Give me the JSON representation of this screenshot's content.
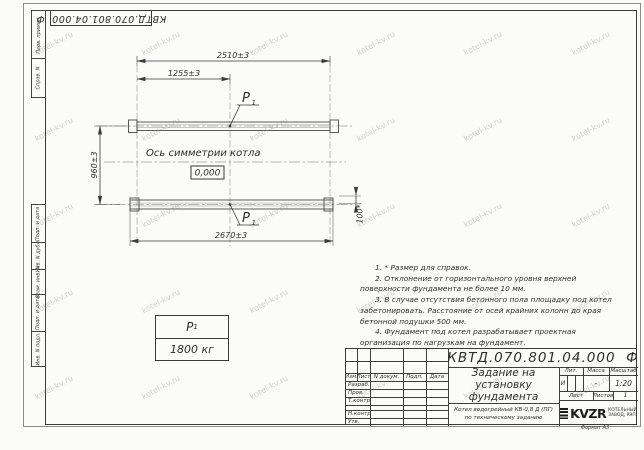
{
  "sheet": {
    "designation_top": "КВТД.070.801.04.000  Ф",
    "format_label": "Формат А3",
    "watermark": "kotel-kv.ru"
  },
  "margin_labels": [
    "Перв. примен.",
    "Справ. N",
    "Подп. и дата",
    "Инв. N дубл.",
    "Взам. инв. N",
    "Подп. и дата",
    "Инв. N подл."
  ],
  "drawing": {
    "dim_top": "2510±3",
    "dim_mid": "1255±3",
    "dim_left": "960±3",
    "dim_bottom": "2670±3",
    "dim_right": "100*",
    "axis_label": "Ось симметрии котла",
    "elevation": "0,000",
    "load_label": "P",
    "load_sub": "1"
  },
  "load_table": {
    "label": "P",
    "sub": "1",
    "value": "1800 кг"
  },
  "notes": [
    "1. * Размер для справок.",
    "2. Отклонение от горизонтального уровня верхней поверхности фундамента не более 10 мм.",
    "3. В случае отсутствия бетонного пола площадку под котел забетонировать. Расстояние от осей крайних колонн до края бетонной подушки 500 мм.",
    "4. Фундамент под котел разрабатывает проектная организация по нагрузкам на фундамент."
  ],
  "title_block": {
    "designation": "КВТД.070.801.04.000  Ф",
    "doc_title": "Задание на установку фундамента",
    "cols": {
      "izm": "Изм.",
      "list": "Лист",
      "doc": "N докум.",
      "sign": "Подп.",
      "date": "Дата"
    },
    "rows": [
      "Разраб.",
      "Пров.",
      "Т.контр.",
      "",
      "Н.контр.",
      "Утв."
    ],
    "lit_label": "Лит.",
    "mass_label": "Масса",
    "scale_label": "Масштаб",
    "lit_value": "И",
    "mass_value": "-",
    "scale_value": "1:20",
    "sheet_label": "Лист",
    "sheets_label": "Листов",
    "sheets_value": "1",
    "product_line1": "Котел водогрейный КВ-0,8 Д (ПГ)",
    "product_line2": "по техническому заданию",
    "logo_text": "KVZR",
    "logo_sub1": "КОТЕЛЬНЫЙ",
    "logo_sub2": "ЗАВОД, РЭП"
  }
}
